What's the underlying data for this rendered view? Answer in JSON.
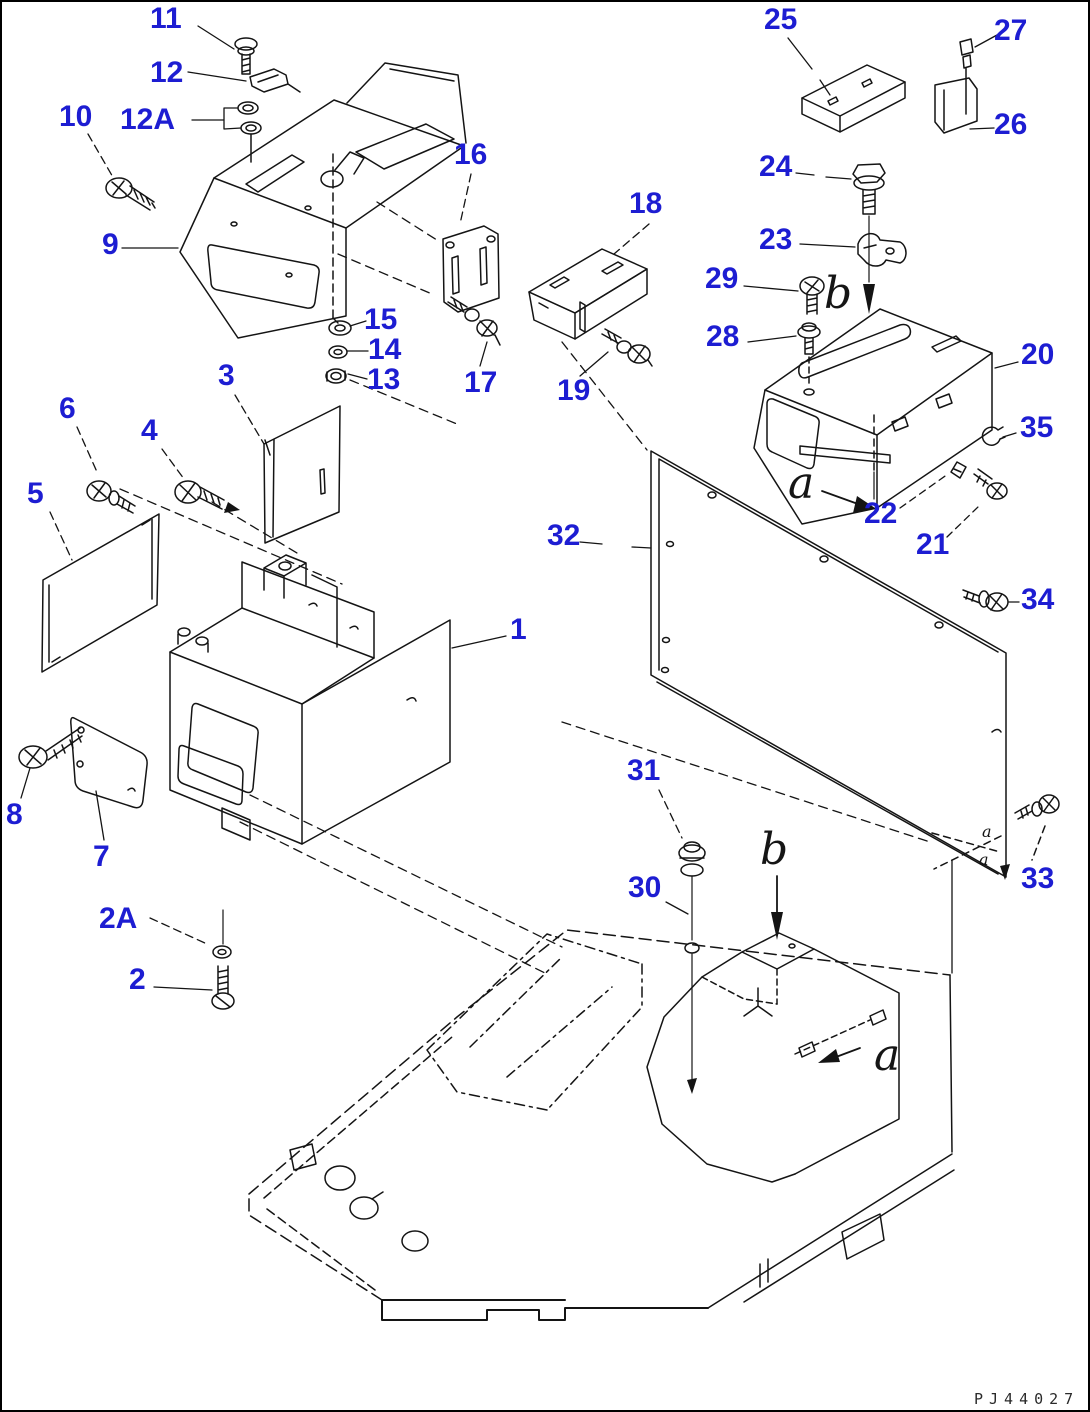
{
  "diagram": {
    "type": "exploded-parts-diagram",
    "drawing_code": "PJ44027",
    "colors": {
      "label": "#1d1dd2",
      "line": "#141414",
      "background": "#ffffff"
    },
    "part_labels": [
      {
        "id": "part-label-11",
        "text": "11",
        "x": 148,
        "y": 2
      },
      {
        "id": "part-label-12",
        "text": "12",
        "x": 148,
        "y": 56
      },
      {
        "id": "part-label-10",
        "text": "10",
        "x": 57,
        "y": 100
      },
      {
        "id": "part-label-12A",
        "text": "12A",
        "x": 118,
        "y": 103
      },
      {
        "id": "part-label-16",
        "text": "16",
        "x": 452,
        "y": 138
      },
      {
        "id": "part-label-9",
        "text": "9",
        "x": 100,
        "y": 228
      },
      {
        "id": "part-label-15",
        "text": "15",
        "x": 362,
        "y": 303
      },
      {
        "id": "part-label-14",
        "text": "14",
        "x": 366,
        "y": 333
      },
      {
        "id": "part-label-13",
        "text": "13",
        "x": 365,
        "y": 363
      },
      {
        "id": "part-label-3",
        "text": "3",
        "x": 216,
        "y": 359
      },
      {
        "id": "part-label-17",
        "text": "17",
        "x": 462,
        "y": 366
      },
      {
        "id": "part-label-19",
        "text": "19",
        "x": 555,
        "y": 374
      },
      {
        "id": "part-label-18",
        "text": "18",
        "x": 627,
        "y": 187
      },
      {
        "id": "part-label-25",
        "text": "25",
        "x": 762,
        "y": 3
      },
      {
        "id": "part-label-27",
        "text": "27",
        "x": 992,
        "y": 14
      },
      {
        "id": "part-label-26",
        "text": "26",
        "x": 992,
        "y": 108
      },
      {
        "id": "part-label-24",
        "text": "24",
        "x": 757,
        "y": 150
      },
      {
        "id": "part-label-23",
        "text": "23",
        "x": 757,
        "y": 223
      },
      {
        "id": "part-label-29",
        "text": "29",
        "x": 703,
        "y": 262
      },
      {
        "id": "part-label-28",
        "text": "28",
        "x": 704,
        "y": 320
      },
      {
        "id": "part-label-20",
        "text": "20",
        "x": 1019,
        "y": 338
      },
      {
        "id": "part-label-35",
        "text": "35",
        "x": 1018,
        "y": 411
      },
      {
        "id": "part-label-22",
        "text": "22",
        "x": 862,
        "y": 497
      },
      {
        "id": "part-label-21",
        "text": "21",
        "x": 914,
        "y": 528
      },
      {
        "id": "part-label-34",
        "text": "34",
        "x": 1019,
        "y": 583
      },
      {
        "id": "part-label-32",
        "text": "32",
        "x": 545,
        "y": 519
      },
      {
        "id": "part-label-6",
        "text": "6",
        "x": 57,
        "y": 392
      },
      {
        "id": "part-label-4",
        "text": "4",
        "x": 139,
        "y": 414
      },
      {
        "id": "part-label-5",
        "text": "5",
        "x": 25,
        "y": 477
      },
      {
        "id": "part-label-1",
        "text": "1",
        "x": 508,
        "y": 613
      },
      {
        "id": "part-label-8",
        "text": "8",
        "x": 4,
        "y": 798
      },
      {
        "id": "part-label-7",
        "text": "7",
        "x": 91,
        "y": 840
      },
      {
        "id": "part-label-2A",
        "text": "2A",
        "x": 97,
        "y": 902
      },
      {
        "id": "part-label-2",
        "text": "2",
        "x": 127,
        "y": 963
      },
      {
        "id": "part-label-31",
        "text": "31",
        "x": 625,
        "y": 754
      },
      {
        "id": "part-label-30",
        "text": "30",
        "x": 626,
        "y": 871
      },
      {
        "id": "part-label-33",
        "text": "33",
        "x": 1019,
        "y": 862
      }
    ],
    "reference_letters": [
      {
        "id": "ref-letter-b-top",
        "text": "b",
        "x": 822,
        "y": 270
      },
      {
        "id": "ref-letter-a-top",
        "text": "a",
        "x": 786,
        "y": 460
      },
      {
        "id": "ref-letter-b-bottom",
        "text": "b",
        "x": 758,
        "y": 826
      },
      {
        "id": "ref-letter-a-bottom",
        "text": "a",
        "x": 872,
        "y": 1032
      }
    ],
    "tiny_letters": [
      {
        "id": "tiny-letter-a-1",
        "text": "a",
        "x": 980,
        "y": 822
      },
      {
        "id": "tiny-letter-a-2",
        "text": "a",
        "x": 977,
        "y": 850
      }
    ]
  }
}
